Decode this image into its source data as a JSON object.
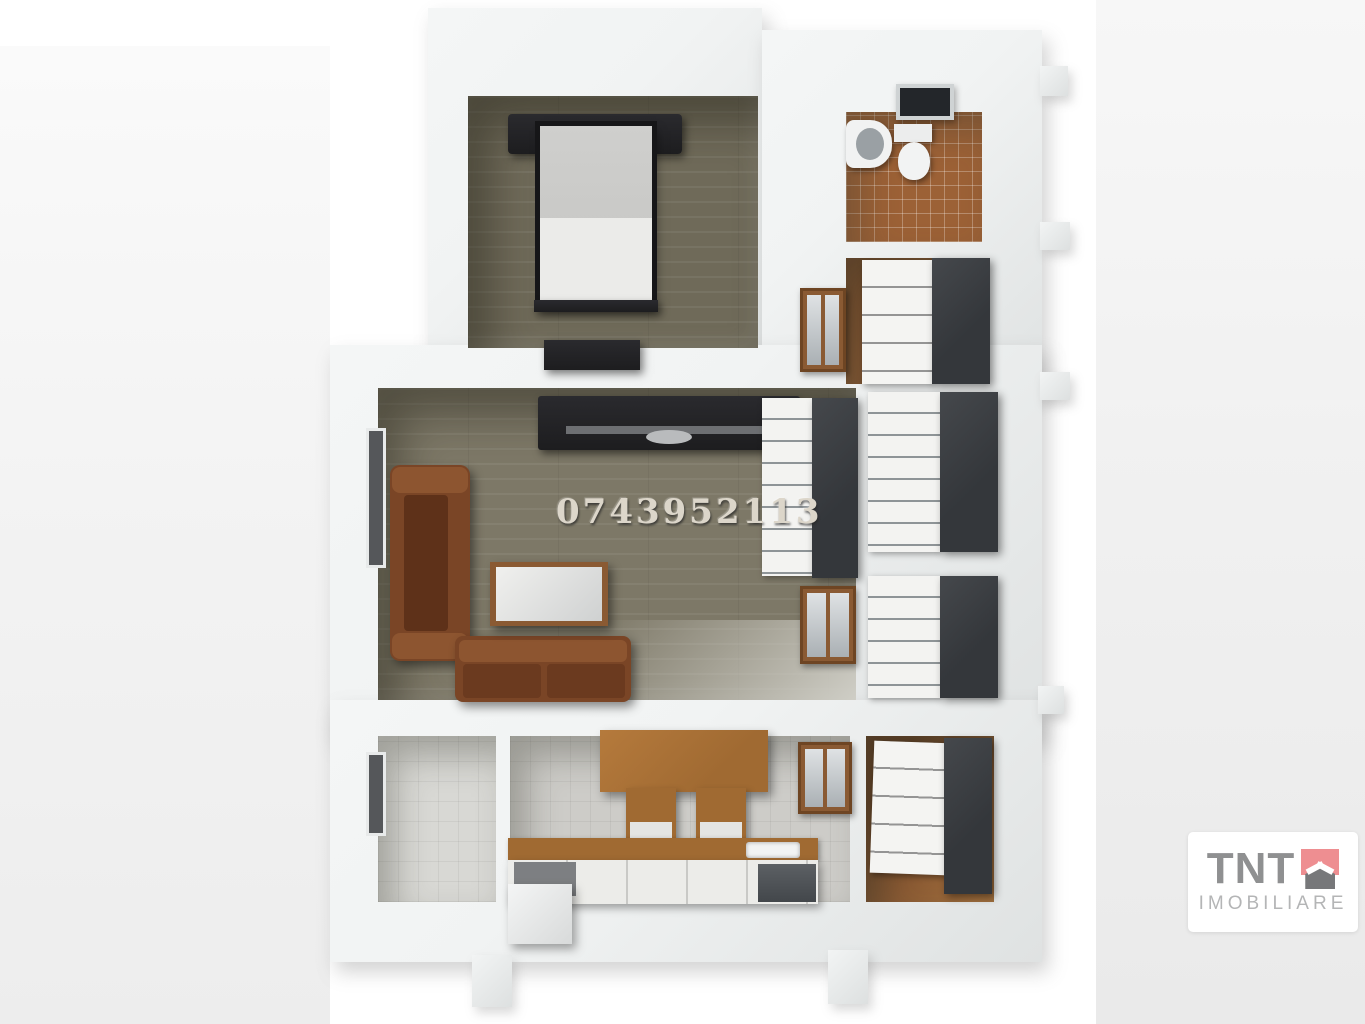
{
  "watermark": {
    "phone_number": "0743952113"
  },
  "logo": {
    "brand": "TNT",
    "subtitle": "IMOBILIARE",
    "colors": {
      "brand_text": "#8f9091",
      "subtitle_text": "#b4b5b6",
      "house_accent": "#ee8e91",
      "house_roof": "#77787a",
      "card_bg": "#ffffff"
    }
  },
  "scene": {
    "colors": {
      "wall_light": "#f1f3f3",
      "wall_shade": "#dfe2e2",
      "bedroom_floor": "#6f6a59",
      "living_floor": "#7d7867",
      "bathroom_tile": "#9c6136",
      "wood_floor": "#8a5a33",
      "kitchen_floor": "#cdccc8",
      "tile_room_floor": "#d8d8d4",
      "dark_cabinet": "#34373b",
      "sofa_brown": "#7a4526",
      "sofa_brown_light": "#8d5530",
      "counter_wood": "#a06a32",
      "black_furniture": "#1d1d1f"
    }
  }
}
